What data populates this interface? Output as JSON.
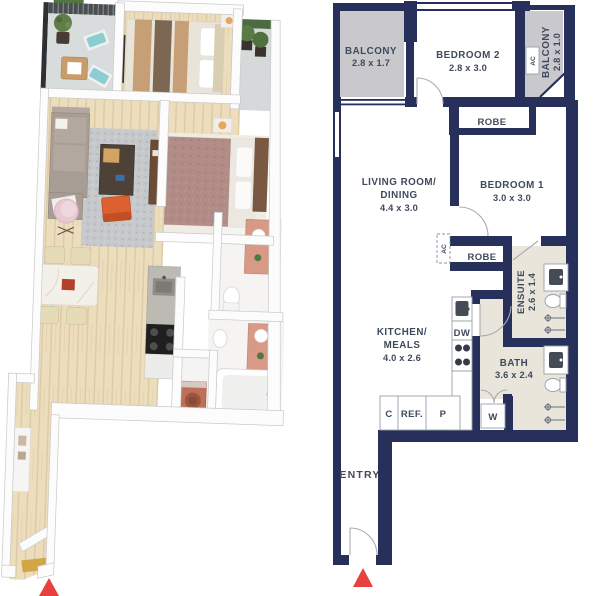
{
  "figure": {
    "type": "floor-plan-pair",
    "left": "3d-render",
    "right": "2d-schematic"
  },
  "plan2d": {
    "balcony1": {
      "name": "BALCONY",
      "dims": "2.8 x 1.7"
    },
    "bedroom2": {
      "name": "BEDROOM 2",
      "dims": "2.8 x 3.0"
    },
    "balcony2": {
      "name": "BALCONY",
      "dims": "2.8 x 1.0"
    },
    "robe1": {
      "name": "ROBE"
    },
    "living": {
      "line1": "LIVING ROOM/",
      "line2": "DINING",
      "dims": "4.4 x 3.0"
    },
    "bedroom1": {
      "name": "BEDROOM 1",
      "dims": "3.0 x 3.0"
    },
    "robe2": {
      "name": "ROBE"
    },
    "ensuite": {
      "name": "ENSUITE",
      "dims": "2.6 x 1.4"
    },
    "kitchen": {
      "line1": "KITCHEN/",
      "line2": "MEALS",
      "dims": "4.0 x 2.6"
    },
    "bath": {
      "name": "BATH",
      "dims": "3.6 x 2.4"
    },
    "entry": {
      "name": "ENTRY"
    },
    "fixtures": {
      "ac": "AC",
      "dishwasher": "DW",
      "washer": "W",
      "cupboard": "C",
      "fridge": "REF.",
      "pantry": "P"
    }
  },
  "colors": {
    "wall": "#26305a",
    "balcony": "#c9c9cd",
    "wet_area": "#e9e5da",
    "label_text": "#3f4a5c",
    "north_arrow": "#e8403c",
    "background": "#ffffff"
  }
}
